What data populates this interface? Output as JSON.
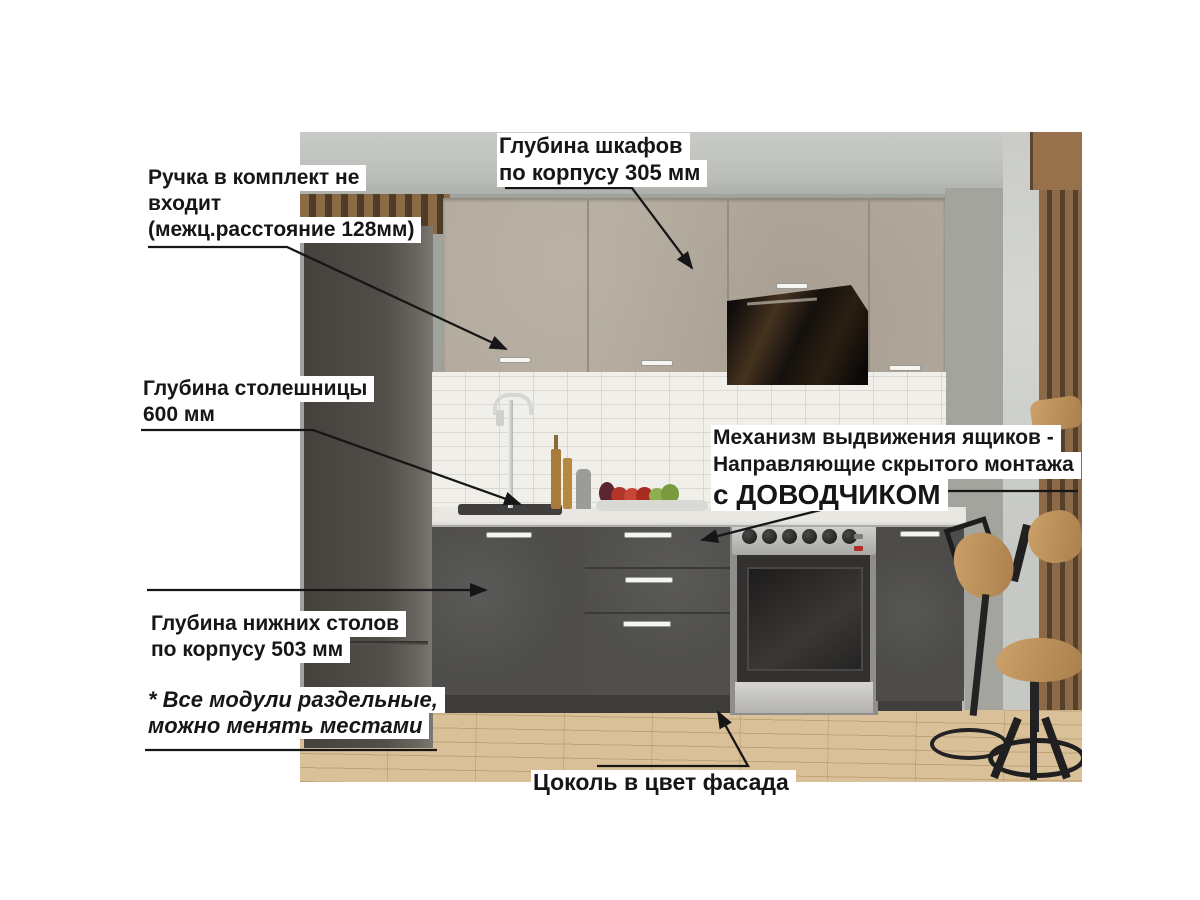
{
  "annotations": {
    "handle_note": {
      "lines": [
        "Ручка в комплект не",
        "входит",
        "(межц.расстояние 128мм)"
      ]
    },
    "upper_cabinet_depth": {
      "lines": [
        "Глубина шкафов",
        " по корпусу 305 мм"
      ]
    },
    "countertop_depth": {
      "lines": [
        "Глубина столешницы",
        " 600 мм"
      ]
    },
    "drawer_mechanism": {
      "lines": [
        "Механизм выдвижения ящиков -",
        "Направляющие скрытого монтажа",
        "с ДОВОДЧИКОМ"
      ]
    },
    "base_cabinet_depth": {
      "lines": [
        "Глубина нижних столов",
        "по корпусу 503 мм"
      ]
    },
    "modules_note": {
      "lines": [
        "* Все модули раздельные,",
        "можно менять местами"
      ]
    },
    "plinth_note": {
      "lines": [
        "Цоколь в цвет фасада"
      ]
    }
  },
  "palette": {
    "annotation_text": "#161616",
    "annotation_bg": "#ffffff",
    "arrow": "#161616",
    "upper_cabinets": "#b2a99c",
    "base_cabinets": "#4e4d4b",
    "countertop": "#e9e7e1",
    "backsplash": "#f0efe9",
    "wall": "#a0a29c",
    "floor": "#d9c098",
    "wood_slats": "#8c6947",
    "hood": "#141210",
    "tall_cabinet": "#524e49"
  }
}
